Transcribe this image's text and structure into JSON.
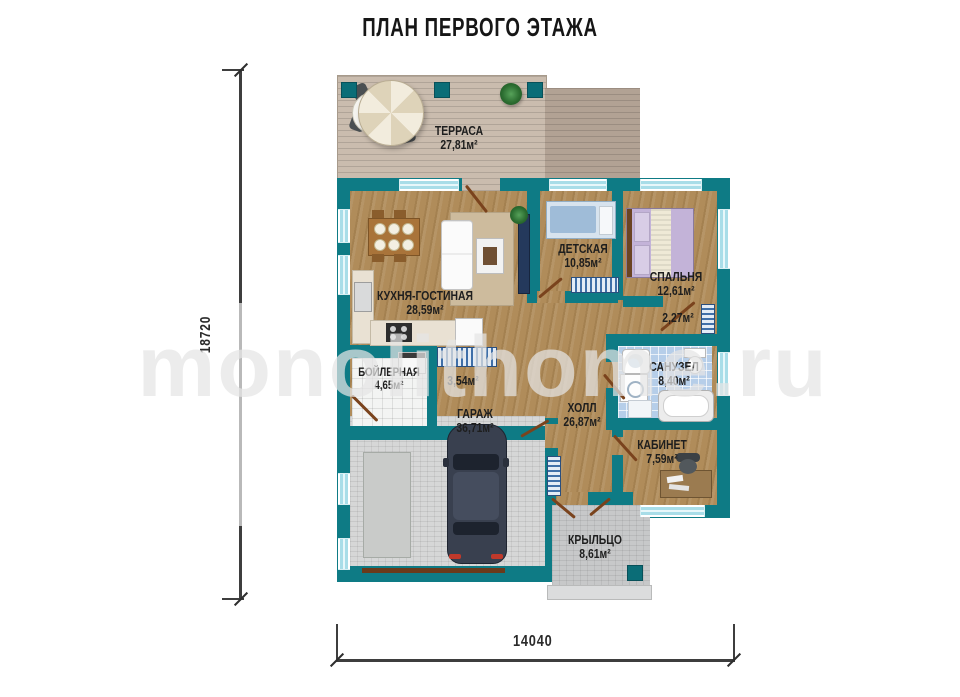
{
  "title": "ПЛАН ПЕРВОГО ЭТАЖА",
  "watermark": "monolithome.ru",
  "dimensions": {
    "vertical": "18720",
    "horizontal": "14040"
  },
  "rooms": {
    "terrace": {
      "name": "ТЕРРАСА",
      "area": "27,81м²"
    },
    "kitchen_living": {
      "name": "КУХНЯ-ГОСТИНАЯ",
      "area": "28,59м²"
    },
    "children": {
      "name": "ДЕТСКАЯ",
      "area": "10,85м²"
    },
    "bedroom": {
      "name": "СПАЛЬНЯ",
      "area": "12,61м²"
    },
    "closet": {
      "area": "2,27м²"
    },
    "boiler": {
      "name": "БОЙЛЕРНАЯ",
      "area": "4,65м²"
    },
    "corridor": {
      "area": "3,54м²"
    },
    "bathroom": {
      "name": "САНУЗЕЛ",
      "area": "8,40м²"
    },
    "garage": {
      "name": "ГАРАЖ",
      "area": "36,71м²"
    },
    "hall": {
      "name": "ХОЛЛ",
      "area": "26,87м²"
    },
    "office": {
      "name": "КАБИНЕТ",
      "area": "7,59м²"
    },
    "porch": {
      "name": "КРЫЛЬЦО",
      "area": "8,61м²"
    }
  },
  "colors": {
    "wall": "#0e7b85",
    "wood_floor": "#b08c5a",
    "bath_tile": "#b6cee9",
    "deck": "#cabcae",
    "concrete": "#d6d7d7"
  }
}
